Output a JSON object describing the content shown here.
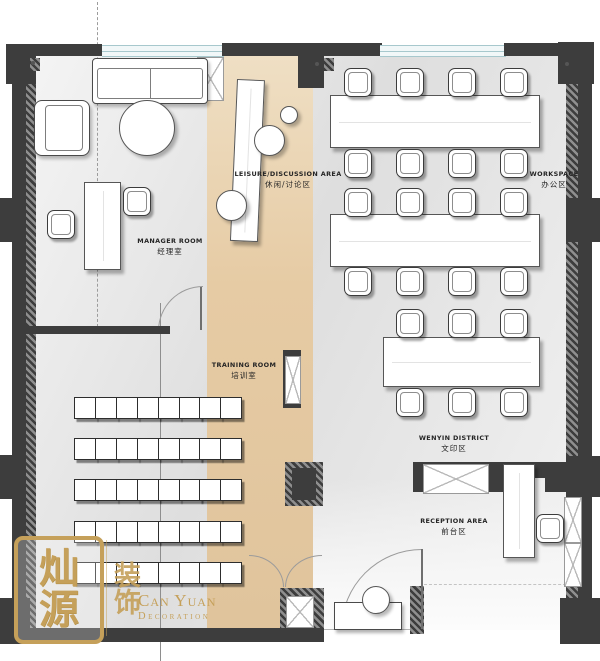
{
  "rooms": [
    {
      "key": "manager",
      "label_en": "MANAGER ROOM",
      "label_cn": "经理室"
    },
    {
      "key": "leisure",
      "label_en": "LEISURE/DISCUSSION AREA",
      "label_cn": "休闲/讨论区"
    },
    {
      "key": "workspace",
      "label_en": "WORKSPACE",
      "label_cn": "办公区"
    },
    {
      "key": "training",
      "label_en": "TRAINING ROOM",
      "label_cn": "培训室"
    },
    {
      "key": "wenyin",
      "label_en": "WENYIN DISTRICT",
      "label_cn": "文印区"
    },
    {
      "key": "reception",
      "label_en": "RECEPTION AREA",
      "label_cn": "前台区"
    }
  ],
  "logo": {
    "seal_chars": [
      "灿",
      "源"
    ],
    "ornament_chars": "装饰",
    "name": "Can Yuan",
    "subtitle": "Decoration"
  },
  "furniture": {
    "training_rows": 5,
    "training_cols": 8,
    "workspace_desks": [
      {
        "chairs_top": 4,
        "chairs_bottom": 4
      },
      {
        "chairs_top": 4,
        "chairs_bottom": 4
      },
      {
        "chairs_top": 3,
        "chairs_bottom": 3
      }
    ]
  },
  "colors": {
    "wall": "#3d3d3d",
    "tan": "#e6cba4",
    "window": "#a7c8cd",
    "gold": "#c5a05a",
    "ink": "#252525"
  }
}
